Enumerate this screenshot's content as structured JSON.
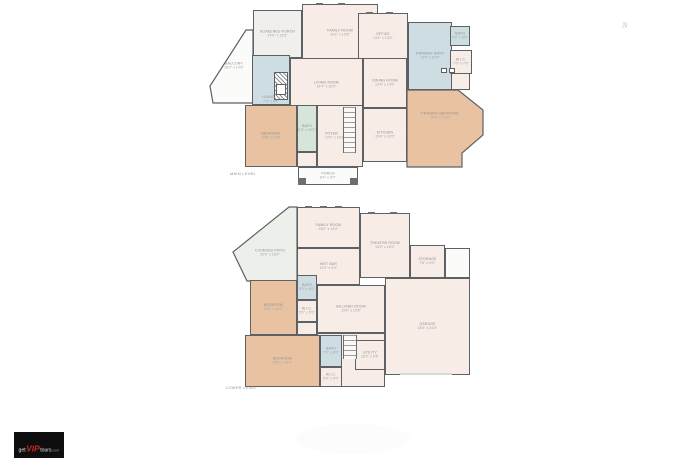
{
  "compass": {
    "label": "N"
  },
  "logo": {
    "text_get": "get",
    "text_vip": "VIP",
    "text_tours": "tours",
    "text_com": ".com"
  },
  "colors": {
    "wall": "#5d6165",
    "cream": "#f7ece6",
    "tan": "#e9c3a1",
    "blue": "#cdddE2",
    "green": "#d7e4da",
    "porchgray": "#f0efec",
    "patio": "#edf0ea",
    "whiteroom": "#fbfbfa",
    "label": "#8d9094",
    "caption": "#8f8e88",
    "brandbg": "#0e0e0e",
    "brandred": "#c9252c"
  },
  "levels": {
    "main": {
      "caption": "MAIN LEVEL",
      "rooms": {
        "screened_porch": {
          "name": "SCREENED PORCH",
          "dims": "14'0\" x 13'6\""
        },
        "family": {
          "name": "FAMILY ROOM",
          "dims": "19'2\" x 13'8\""
        },
        "office": {
          "name": "OFFICE",
          "dims": "13'4\" x 13'0\""
        },
        "balcony": {
          "name": "BALCONY",
          "dims": "28'0\" x 14'6\""
        },
        "primary_bath": {
          "name": "PRIMARY BATH",
          "dims": "13'0\" x 10'0\""
        },
        "bath_top": {
          "name": "BATH",
          "dims": "6'0\" x 6'0\""
        },
        "wic": {
          "name": "W.I.C.",
          "dims": "7'0\" x 7'0\""
        },
        "laundry": {
          "name": "LAUNDRY",
          "dims": "7'0\" x 6'6\""
        },
        "living": {
          "name": "LIVING ROOM",
          "dims": "24'4\" x 16'0\""
        },
        "dining": {
          "name": "DINING ROOM",
          "dims": "13'4\" x 14'0\""
        },
        "kitchen": {
          "name": "KITCHEN",
          "dims": "15'4\" x 13'0\""
        },
        "primary_bedroom": {
          "name": "PRIMARY BEDROOM",
          "dims": "19'4\" x 13'0\""
        },
        "bedroom": {
          "name": "BEDROOM",
          "dims": "13'8\" x 13'0\""
        },
        "bath_hall": {
          "name": "BATH",
          "dims": "5'0\" x 10'0\""
        },
        "foyer": {
          "name": "FOYER",
          "dims": "10'0\" x 10'0\""
        },
        "porch": {
          "name": "PORCH",
          "dims": "8'4\" x 5'0\""
        }
      }
    },
    "lower": {
      "caption": "LOWER LEVEL",
      "rooms": {
        "covered_patio": {
          "name": "COVERED PATIO",
          "dims": "20'0\" x 18'0\""
        },
        "family": {
          "name": "FAMILY ROOM",
          "dims": "16'0\" x 14'0\""
        },
        "wet_bar": {
          "name": "WET BAR",
          "dims": "10'0\" x 9'0\""
        },
        "theatre": {
          "name": "THEATRE ROOM",
          "dims": "15'0\" x 18'0\""
        },
        "storage": {
          "name": "STORAGE",
          "dims": "7'6\" x 6'0\""
        },
        "bedroom1": {
          "name": "BEDROOM",
          "dims": "13'0\" x 14'0\""
        },
        "bath1": {
          "name": "BATH",
          "dims": "5'0\" x 8'0\""
        },
        "wic1": {
          "name": "W.I.C.",
          "dims": "5'0\" x 5'0\""
        },
        "billiard": {
          "name": "BILLIARD ROOM",
          "dims": "19'0\" x 15'6\""
        },
        "garage": {
          "name": "GARAGE",
          "dims": "23'0\" x 24'0\""
        },
        "bedroom2": {
          "name": "BEDROOM",
          "dims": "15'0\" x 13'0\""
        },
        "bath2": {
          "name": "BATH",
          "dims": "7'0\" x 8'0\""
        },
        "wic2": {
          "name": "W.I.C.",
          "dims": "5'0\" x 5'0\""
        },
        "utility": {
          "name": "UTILITY",
          "dims": "10'0\" x 6'8\""
        }
      }
    }
  }
}
